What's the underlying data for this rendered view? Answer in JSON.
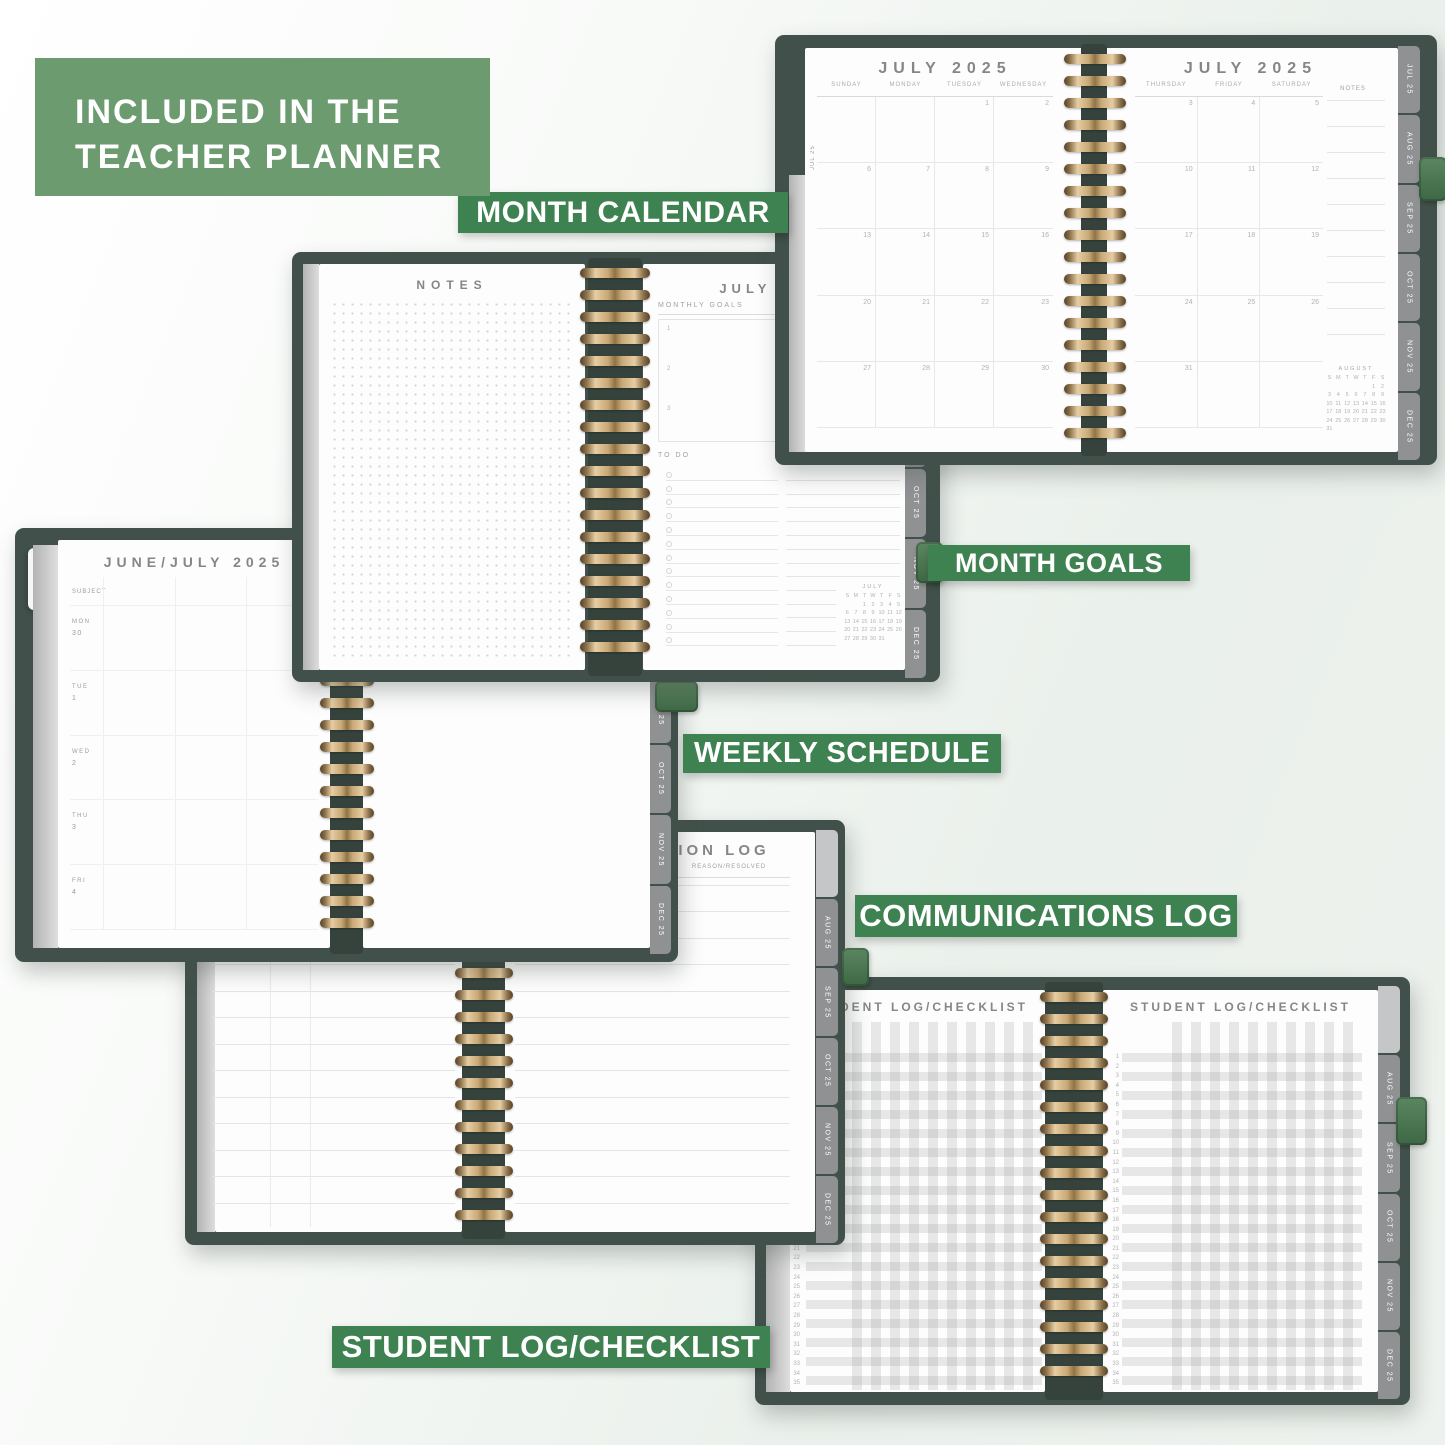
{
  "header_box": {
    "line1": "INCLUDED IN THE",
    "line2": "TEACHER PLANNER"
  },
  "banners": {
    "month_calendar": "MONTH CALENDAR",
    "month_goals": "MONTH GOALS",
    "weekly_schedule": "WEEKLY SCHEDULE",
    "communications_log": "COMMUNICATIONS LOG",
    "student_log": "STUDENT LOG/CHECKLIST"
  },
  "tabs": [
    "JUL 25",
    "AUG 25",
    "SEP 25",
    "OCT 25",
    "NOV 25",
    "DEC 25"
  ],
  "month_calendar": {
    "left": {
      "edge_label": "JUL 25",
      "title": "JULY 2025",
      "days": [
        "SUNDAY",
        "MONDAY",
        "TUESDAY",
        "WEDNESDAY"
      ],
      "weeks": [
        [
          "",
          "",
          "1",
          "2"
        ],
        [
          "6",
          "7",
          "8",
          "9"
        ],
        [
          "13",
          "14",
          "15",
          "16"
        ],
        [
          "20",
          "21",
          "22",
          "23"
        ],
        [
          "27",
          "28",
          "29",
          "30"
        ]
      ]
    },
    "right": {
      "title": "JULY 2025",
      "days": [
        "THURSDAY",
        "FRIDAY",
        "SATURDAY"
      ],
      "notes_label": "NOTES",
      "weeks": [
        [
          "3",
          "4",
          "5"
        ],
        [
          "10",
          "11",
          "12"
        ],
        [
          "17",
          "18",
          "19"
        ],
        [
          "24",
          "25",
          "26"
        ],
        [
          "31",
          "",
          ""
        ]
      ],
      "mini_calendar": {
        "title": "AUGUST",
        "day_header": [
          "S",
          "M",
          "T",
          "W",
          "T",
          "F",
          "S"
        ],
        "weeks": [
          [
            "",
            "",
            "",
            "",
            "",
            "1",
            "2"
          ],
          [
            "3",
            "4",
            "5",
            "6",
            "7",
            "8",
            "9"
          ],
          [
            "10",
            "11",
            "12",
            "13",
            "14",
            "15",
            "16"
          ],
          [
            "17",
            "18",
            "19",
            "20",
            "21",
            "22",
            "23"
          ],
          [
            "24",
            "25",
            "26",
            "27",
            "28",
            "29",
            "30"
          ],
          [
            "31",
            "",
            "",
            "",
            "",
            "",
            ""
          ]
        ]
      }
    }
  },
  "notes_goals": {
    "left_title": "NOTES",
    "right": {
      "title": "JULY 2025",
      "goals_label": "MONTHLY GOALS",
      "goal_numbers": [
        "1",
        "2",
        "3"
      ],
      "todo_label": "TO DO",
      "mini_calendar": {
        "title": "JULY",
        "day_header": [
          "S",
          "M",
          "T",
          "W",
          "T",
          "F",
          "S"
        ],
        "weeks": [
          [
            "",
            "",
            "1",
            "2",
            "3",
            "4",
            "5"
          ],
          [
            "6",
            "7",
            "8",
            "9",
            "10",
            "11",
            "12"
          ],
          [
            "13",
            "14",
            "15",
            "16",
            "17",
            "18",
            "19"
          ],
          [
            "20",
            "21",
            "22",
            "23",
            "24",
            "25",
            "26"
          ],
          [
            "27",
            "28",
            "29",
            "30",
            "31",
            "",
            ""
          ]
        ]
      }
    }
  },
  "weekly_schedule": {
    "edge_label": "JUL 25",
    "title": "JUNE/JULY 2025",
    "subject_label": "SUBJECT",
    "rows": [
      {
        "day": "MON",
        "date": "30"
      },
      {
        "day": "TUE",
        "date": "1"
      },
      {
        "day": "WED",
        "date": "2"
      },
      {
        "day": "THU",
        "date": "3"
      },
      {
        "day": "FRI",
        "date": "4"
      }
    ]
  },
  "communication_log": {
    "title": "COMMUNICATION LOG",
    "column_label": "REASON/RESOLVED"
  },
  "student_log": {
    "left_title": "STUDENT LOG/CHECKLIST",
    "right_title": "STUDENT LOG/CHECKLIST",
    "row_count": 35
  },
  "colors": {
    "banner_green": "#3E8251",
    "header_green": "#6B9B6F",
    "cover_green": "#41504A",
    "loop_green": "#4D7B54",
    "coil_gold": "#D8BA8E",
    "tab_gray": "#8F9193"
  }
}
